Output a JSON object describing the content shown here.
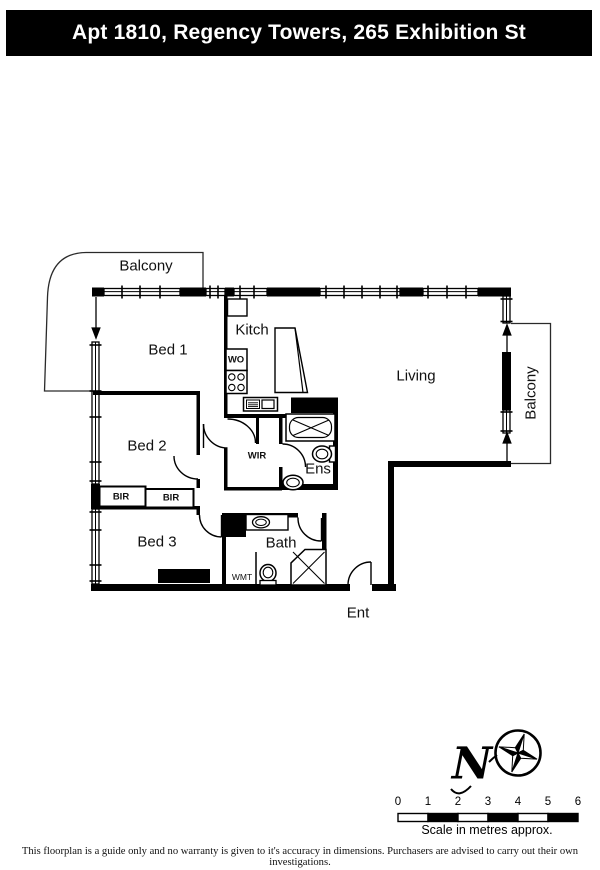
{
  "header": {
    "title": "Apt 1810, Regency Towers, 265 Exhibition St"
  },
  "labels": {
    "balcony_top": "Balcony",
    "bed1": "Bed 1",
    "kitchen": "Kitch",
    "living": "Living",
    "balcony_right": "Balcony",
    "bed2": "Bed 2",
    "wir": "WIR",
    "ens": "Ens",
    "bir_left": "BIR",
    "bir_right": "BIR",
    "bed3": "Bed 3",
    "bath": "Bath",
    "wmt": "WMT",
    "wo": "WO",
    "entry": "Ent"
  },
  "icons": [
    "compass-rose-icon",
    "bathtub-icon",
    "toilet-icon",
    "shower-icon",
    "stove-cooktop-icon",
    "kitchen-sink-icon",
    "vanity-basin-icon",
    "door-swing-arc",
    "balcony-access-arrow",
    "window-wall-hatching"
  ],
  "compass": {
    "letter": "N"
  },
  "scale_bar": {
    "ticks": [
      "0",
      "1",
      "2",
      "3",
      "4",
      "5",
      "6"
    ],
    "caption": "Scale in metres approx."
  },
  "footer": {
    "disclaimer": "This floorplan is a guide only and no warranty is given to it's accuracy in dimensions. Purchasers are advised to carry out their own investigations."
  },
  "colors": {
    "wall": "#000000",
    "background": "#ffffff",
    "header_bg": "#000000",
    "header_text": "#ffffff"
  }
}
